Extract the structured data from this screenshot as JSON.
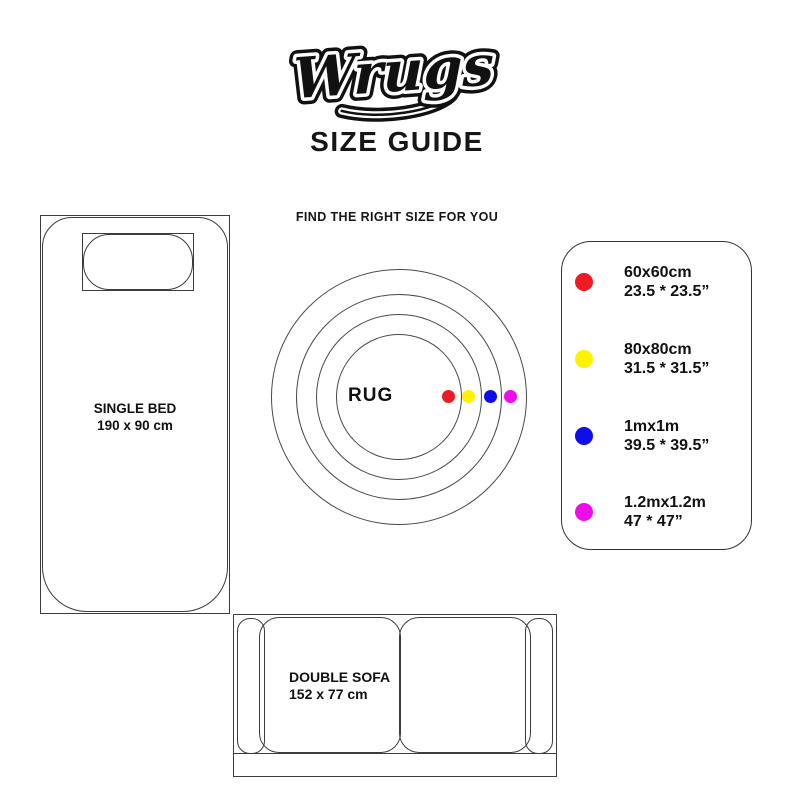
{
  "logo": {
    "text": "Wrugs"
  },
  "header": {
    "title": "SIZE GUIDE",
    "subtitle": "FIND THE RIGHT SIZE FOR YOU"
  },
  "bed": {
    "name": "SINGLE BED",
    "dimensions": "190 x 90 cm"
  },
  "rug": {
    "label": "RUG"
  },
  "sofa": {
    "name": "DOUBLE SOFA",
    "dimensions": "152 x 77 cm"
  },
  "legend": {
    "items": [
      {
        "color_name": "red",
        "color": "#ed1c24",
        "size_cm": "60x60cm",
        "size_in": "23.5 * 23.5”"
      },
      {
        "color_name": "yellow",
        "color": "#fff200",
        "size_cm": "80x80cm",
        "size_in": "31.5 * 31.5”"
      },
      {
        "color_name": "blue",
        "color": "#0d0ee8",
        "size_cm": "1mx1m",
        "size_in": "39.5 * 39.5”"
      },
      {
        "color_name": "magenta",
        "color": "#ee0cea",
        "size_cm": "1.2mx1.2m",
        "size_in": "47 * 47”"
      }
    ]
  }
}
